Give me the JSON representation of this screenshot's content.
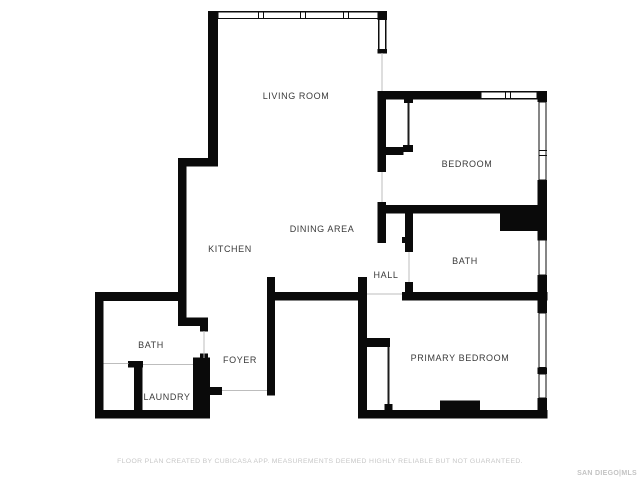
{
  "document_type": "floor-plan",
  "rooms": {
    "living_room": {
      "label": "LIVING ROOM"
    },
    "bedroom": {
      "label": "BEDROOM"
    },
    "dining_area": {
      "label": "DINING AREA"
    },
    "kitchen": {
      "label": "KITCHEN"
    },
    "hall": {
      "label": "HALL"
    },
    "bath": {
      "label": "BATH"
    },
    "primary_bedroom": {
      "label": "PRIMARY BEDROOM"
    },
    "bath_2": {
      "label": "BATH"
    },
    "foyer": {
      "label": "FOYER"
    },
    "laundry": {
      "label": "LAUNDRY"
    }
  },
  "footer": {
    "disclaimer": "FLOOR PLAN CREATED BY CUBICASA APP. MEASUREMENTS DEEMED HIGHLY RELIABLE BUT NOT GUARANTEED.",
    "logo": "SAN DIEGO|MLS"
  },
  "colors": {
    "wall": "#0a0a0a",
    "label_text": "#3a3a3a",
    "footer_text": "#c7c7c7",
    "background": "#ffffff"
  }
}
